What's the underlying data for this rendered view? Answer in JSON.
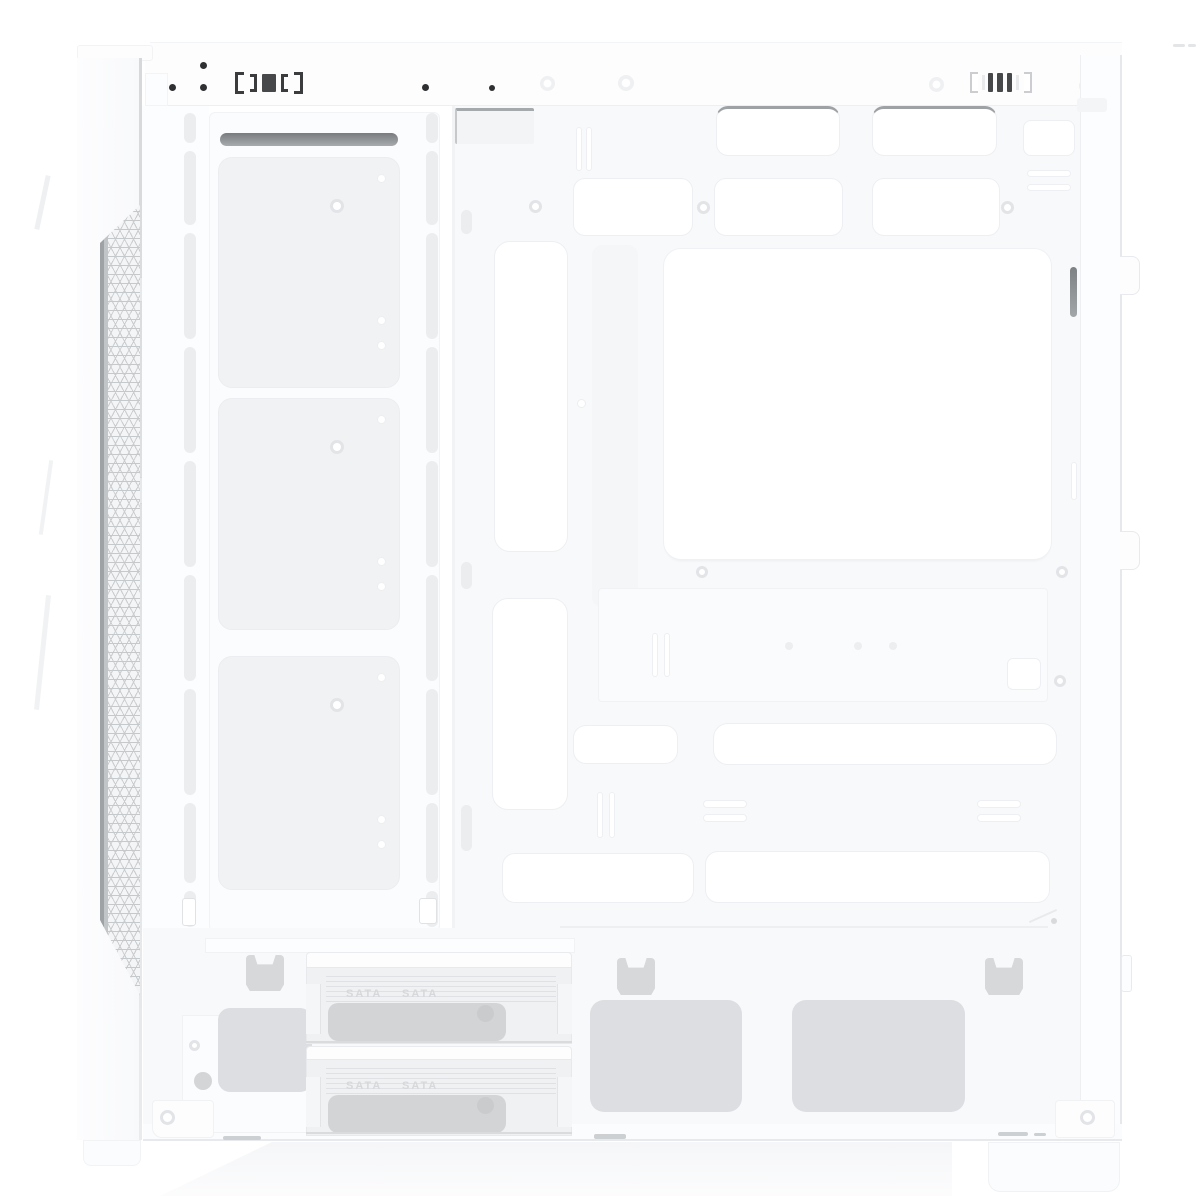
{
  "product": {
    "description": "White mid-tower PC case, side view with side panel removed"
  },
  "drive_cage": {
    "trays": [
      {
        "labels": [
          "SATA",
          "SATA"
        ]
      },
      {
        "labels": [
          "SATA",
          "SATA"
        ]
      }
    ]
  },
  "colors": {
    "background": "#ffffff",
    "chassis_surface": "#f8f9fa",
    "bracket_white": "#fbfcfd",
    "cutout_white": "#ffffff",
    "cutout_edge": "#edeff2",
    "vent_pad_gray": "#dcdee1",
    "tray_gray": "#eff1f3",
    "tray_insert_gray": "#d2d4d6",
    "mesh_line": "#c6c9cc",
    "mesh_edge_dark": "#9fa2a5",
    "screw_dark": "#2f3032",
    "detail_line": "#e7e9ec"
  }
}
